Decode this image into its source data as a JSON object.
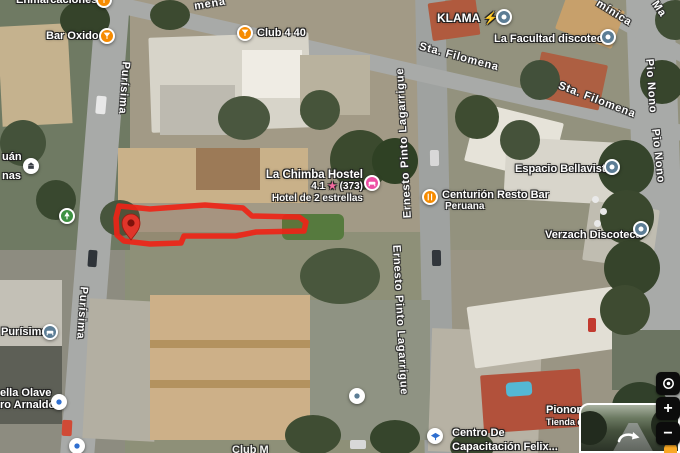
{
  "labels": {
    "enmarcaciones": "Enmarcaciones",
    "bar_oxido": "Bar Oxido",
    "club440": "Club 4 40",
    "klama": "KLAMA",
    "klama_bolt": "⚡",
    "la_facultad": "La Facultad discoteca",
    "chimba_name": "La Chimba Hostel",
    "chimba_rating": "4.1",
    "chimba_star": "★",
    "chimba_reviews": "(373)",
    "chimba_subtitle": "Hotel de 2 estrellas",
    "centurion_name": "Centurión Resto Bar",
    "centurion_subtitle": "Peruana",
    "espacio": "Espacio Bellavista",
    "verzach": "Verzach Discoteca",
    "purisima_poi": "Purísima",
    "olave_line1": "ella Olave",
    "olave_line2": "ro Arnaldo",
    "juan_line1": "uán",
    "juan_line2": "nas",
    "centro_line1": "Centro De",
    "centro_line2": "Capacitación Felix...",
    "pionono_name": "Pionono",
    "pionono_subtitle": "Tienda d",
    "club_m": "Club M"
  },
  "streets": {
    "purisima_n": "Purísima",
    "purisima_s": "Purísima",
    "filomena_top": "mena",
    "sta_filomena_a": "Sta. Filomena",
    "sta_filomena_b": "Sta. Filomena",
    "dominica": "mínica",
    "ma": "Ma",
    "pio_nono_a": "Pio Nono",
    "pio_nono_b": "Pio Nono",
    "lagarrigue_a": "Ernesto Pinto Lagarrigue",
    "lagarrigue_b": "Ernesto Pinto Lagarrigue"
  },
  "controls": {
    "zoom_in": "+",
    "zoom_out": "−"
  },
  "colors": {
    "poi_orange": "#f68b00",
    "poi_blue": "#5c7d95",
    "poi_pink": "#ee4fa5",
    "poi_green": "#3e9142",
    "selection_red": "#ee2417",
    "rating_star": "#f46ba0"
  }
}
